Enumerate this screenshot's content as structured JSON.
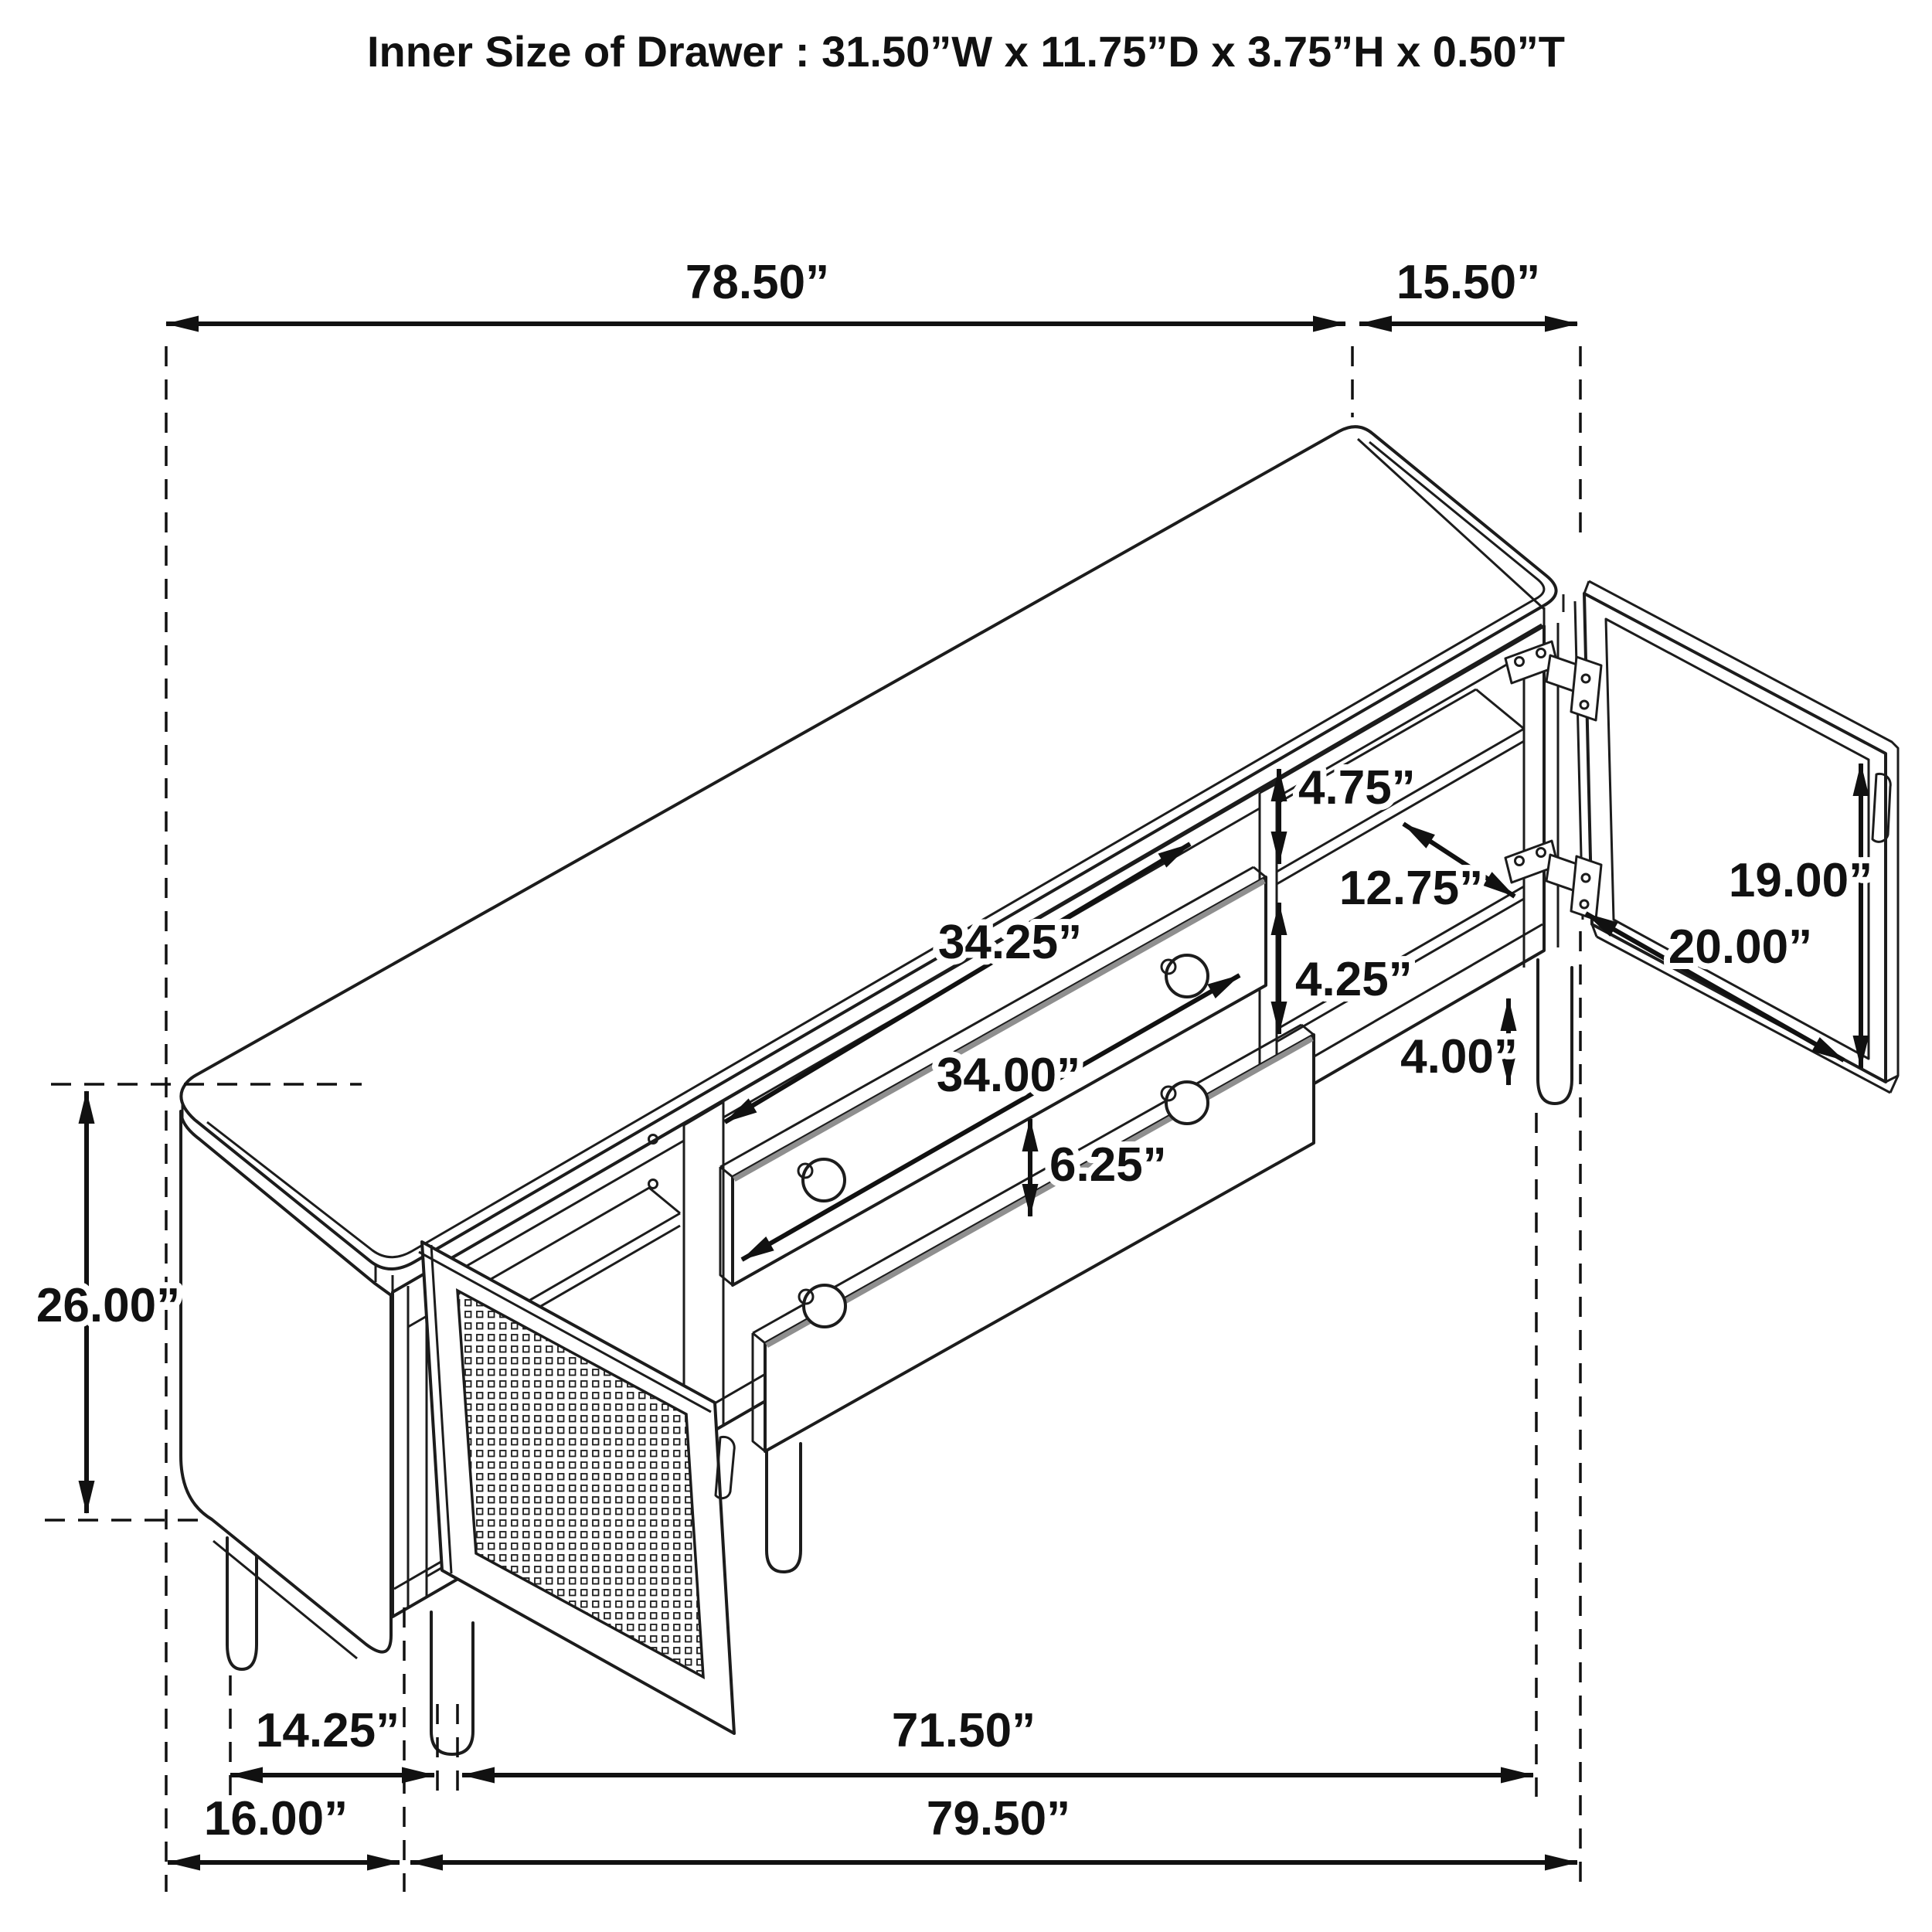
{
  "title": "Inner Size of Drawer : 31.50”W x 11.75”D x 3.75”H x 0.50”T",
  "diagram_type": "furniture-dimension-line-drawing",
  "colors": {
    "ink": "#1c1c1c",
    "accent_gray": "#8f8f8f",
    "background": "#ffffff"
  },
  "dims": {
    "d78_50": "78.50”",
    "d15_50": "15.50”",
    "d26_00": "26.00”",
    "d14_25": "14.25”",
    "d71_50": "71.50”",
    "d16_00": "16.00”",
    "d79_50": "79.50”",
    "d4_75": "4.75”",
    "d12_75": "12.75”",
    "d4_25": "4.25”",
    "d4_00": "4.00”",
    "d19_00": "19.00”",
    "d20_00": "20.00”",
    "d34_25": "34.25”",
    "d34_00": "34.00”",
    "d6_25": "6.25”"
  }
}
